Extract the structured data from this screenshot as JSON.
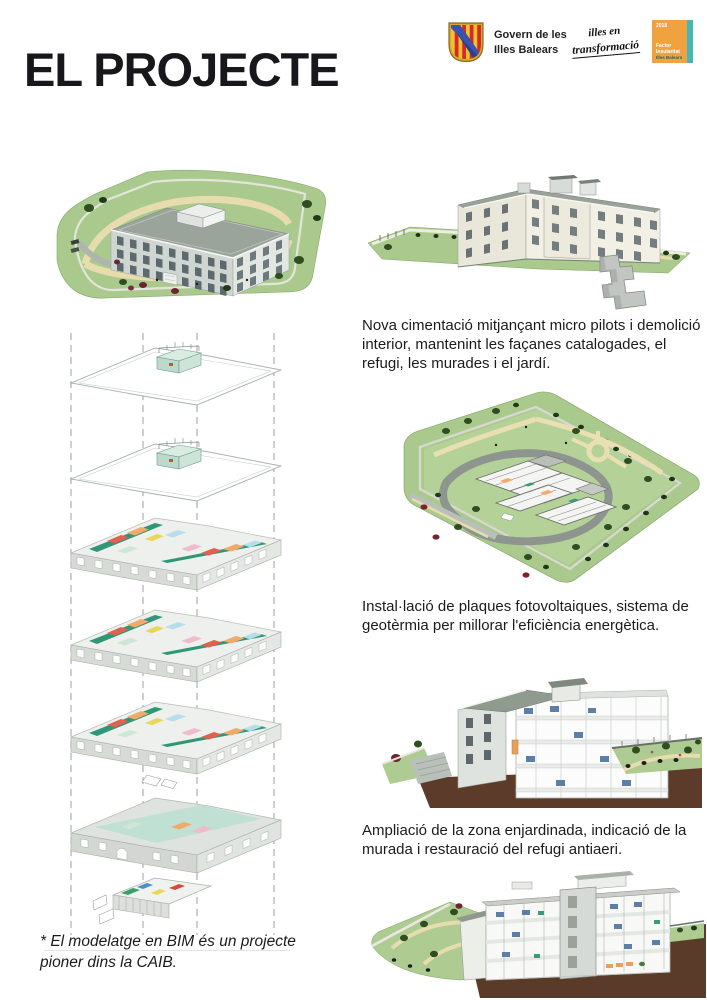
{
  "page": {
    "title": "EL PROJECTE"
  },
  "header": {
    "govern": {
      "line1": "Govern de les",
      "line2": "Illes Balears"
    },
    "transformacio": {
      "line1": "illes en",
      "line2": "transformació"
    },
    "factor": {
      "year": "2018",
      "line1": "Factor",
      "line2": "Insularitat",
      "line3": "Illes Balears"
    }
  },
  "main": {
    "captions": {
      "foundation": "Nova cimentació mitjançant micro pilots i demolició interior, mantenint les façanes catalogades, el refugi, les murades i el jardí.",
      "energy": "Instal·lació de plaques fotovoltaiques, sistema de geotèrmia per millorar l'eficiència energètica.",
      "garden": "Ampliació de la zona enjardinada, indicació de la murada i restauració del refugi antiaeri."
    },
    "footnote": "* El modelatge en BIM és un projecte pioner dins la CAIB."
  },
  "colors": {
    "lawn_green": "#a9c98d",
    "lawn_light": "#b6d29a",
    "path_tan": "#e9dfb2",
    "earth_brown": "#5d3b2a",
    "facade_gray": "#cfd5d1",
    "facade_cream": "#f2efe5",
    "roof_gray": "#98a299",
    "corridor_teal": "#2f9678",
    "room_coral": "#e0614f",
    "room_orange": "#f2a96a",
    "room_yellow": "#e8d75a",
    "room_blue": "#b9dcea",
    "room_pink": "#f0bccc",
    "tree_green": "#2e4d20",
    "tree_red": "#6e2531",
    "factor_orange": "#F0A23F",
    "factor_teal": "#45B7B8"
  }
}
